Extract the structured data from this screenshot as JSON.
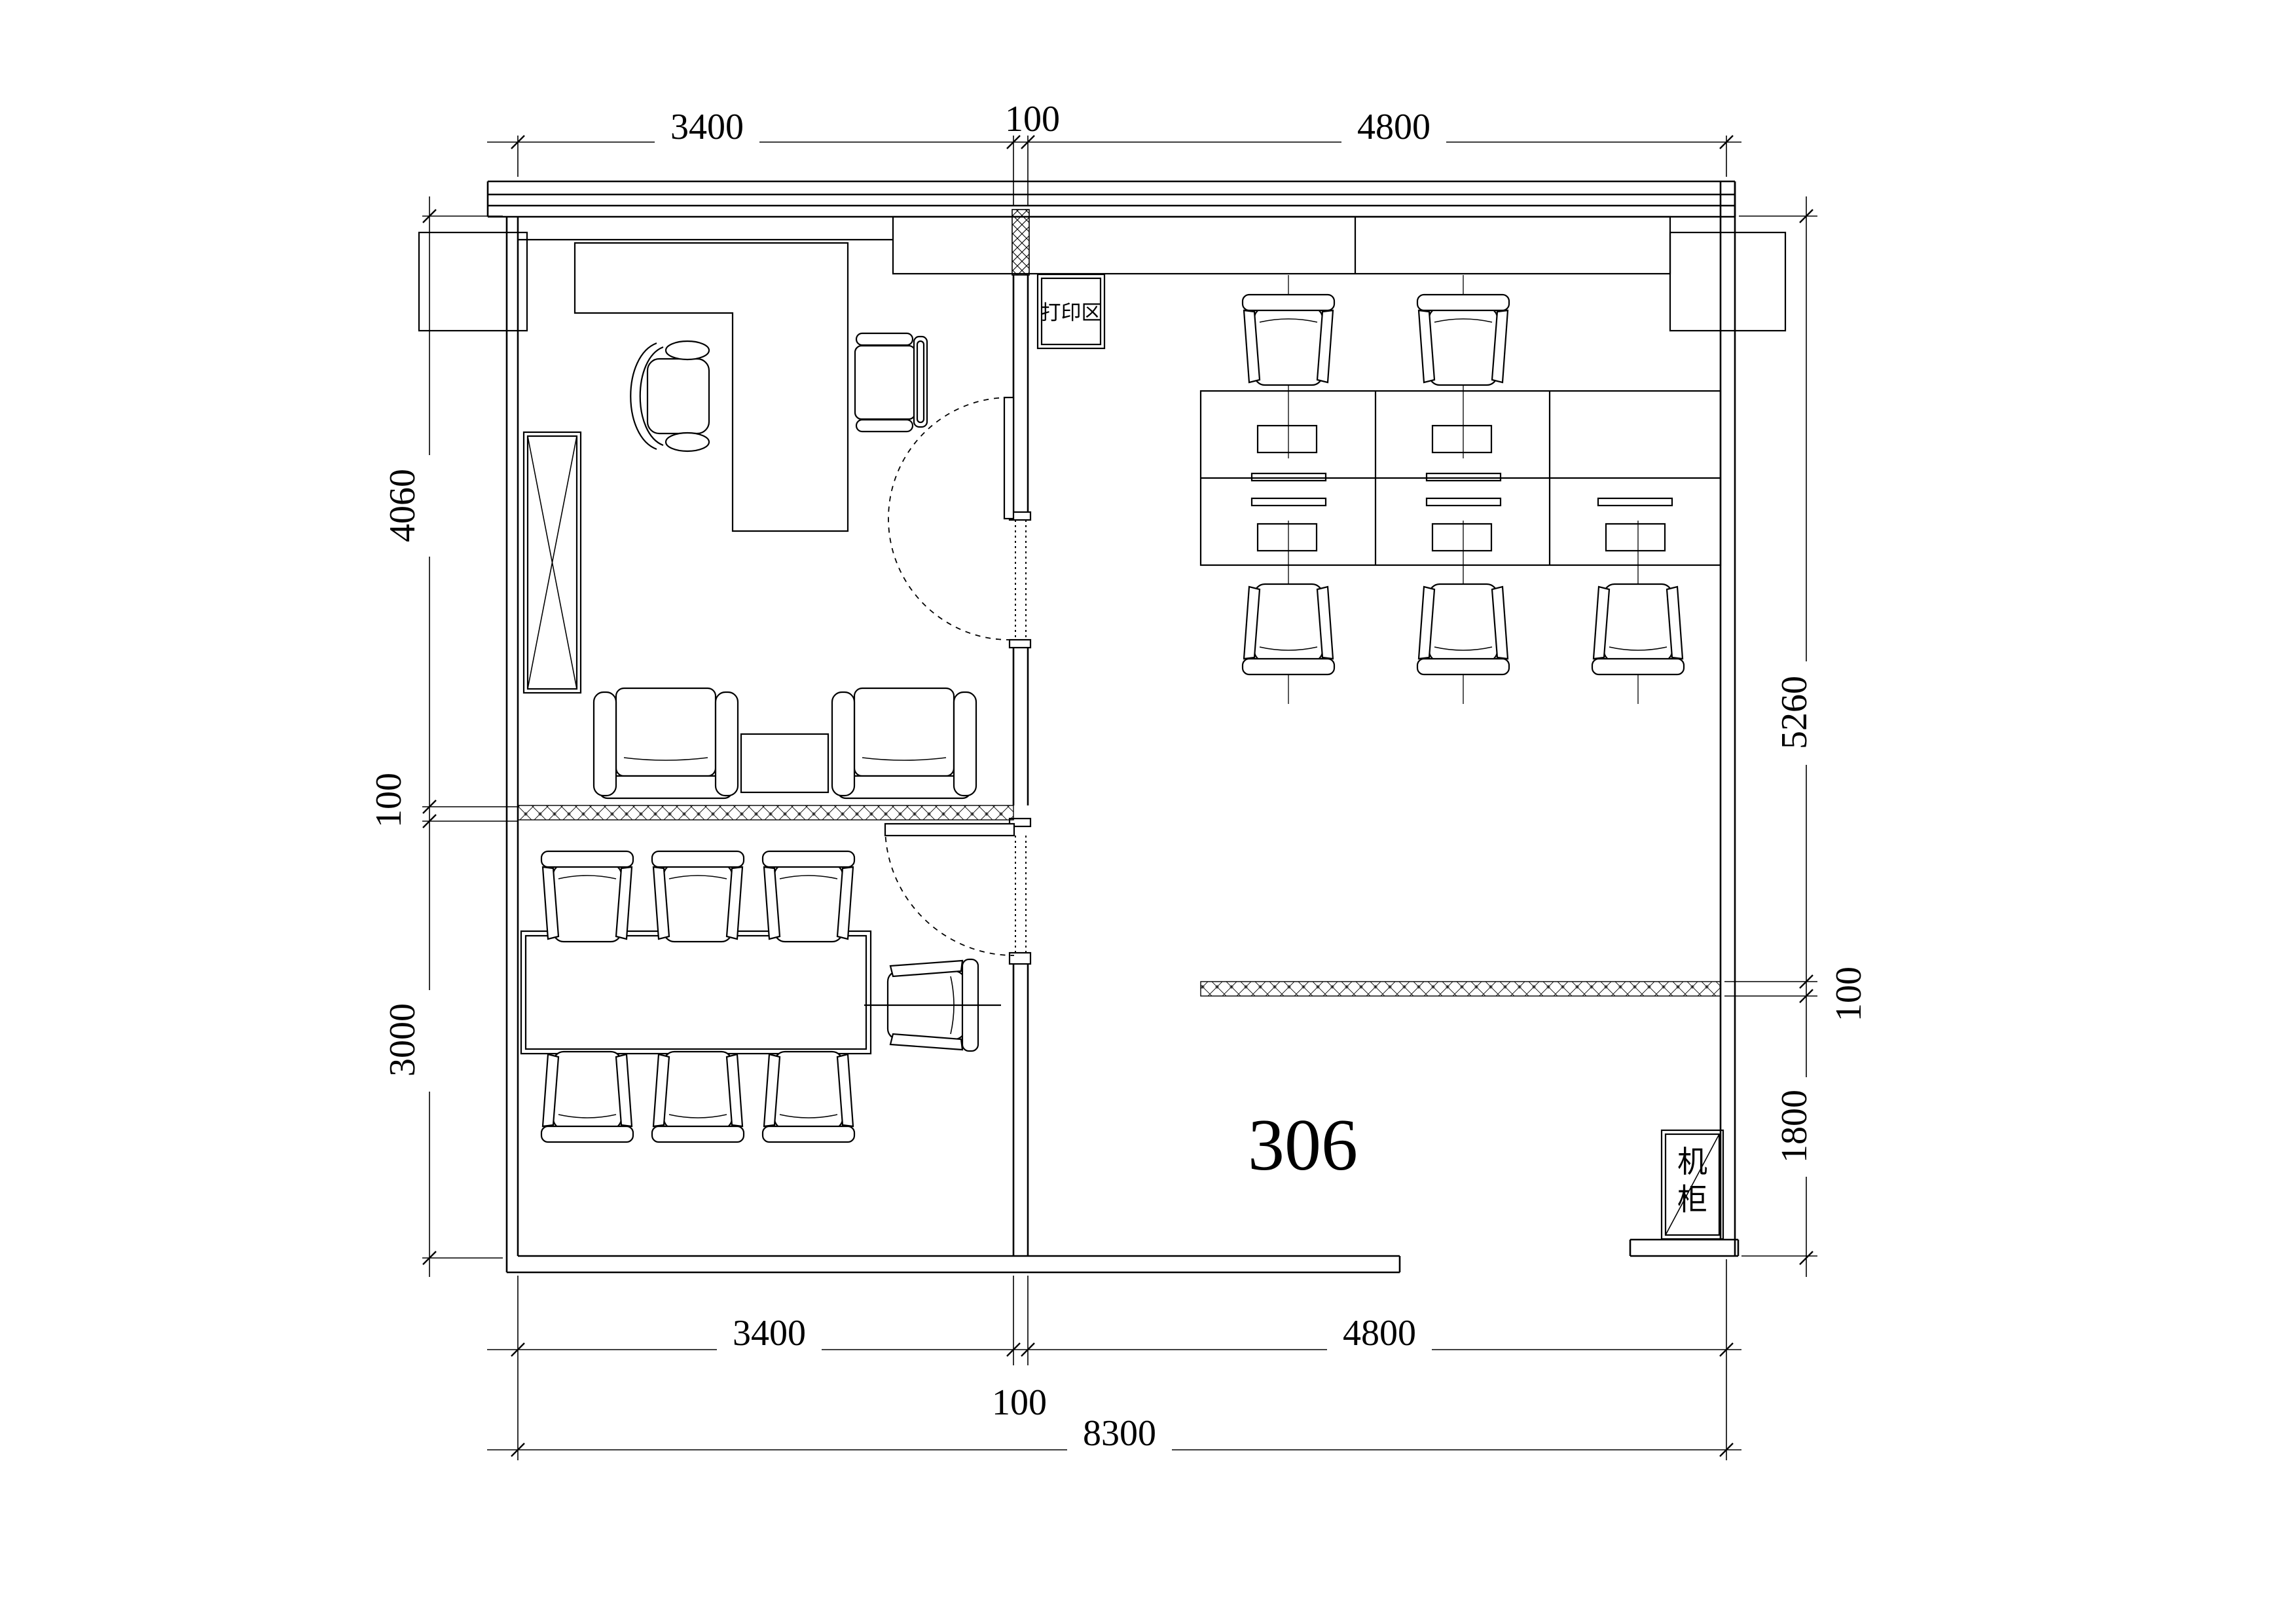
{
  "colors": {
    "background": "#ffffff",
    "line": "#000000"
  },
  "labels": {
    "room_number": "306",
    "print_area": "打印区",
    "server_cabinet": "机柜"
  },
  "dimensions": {
    "top": {
      "left": "3400",
      "middle": "100",
      "right": "4800"
    },
    "bottom": {
      "left": "3400",
      "middle": "100",
      "right": "4800",
      "total": "8300"
    },
    "left": {
      "top": "4060",
      "middle": "100",
      "bottom": "3000"
    },
    "right": {
      "top": "5260",
      "middle": "100",
      "bottom": "1800"
    }
  }
}
